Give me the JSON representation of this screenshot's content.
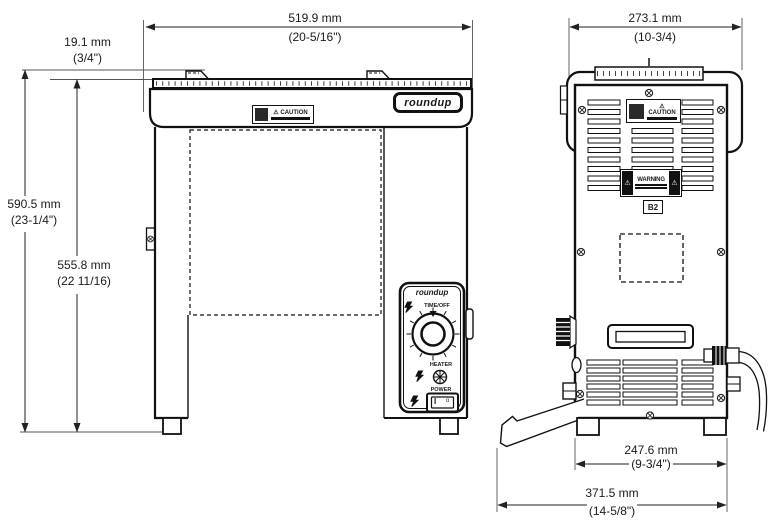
{
  "product": {
    "brand": "roundup"
  },
  "dimensions": {
    "overall_width": {
      "mm": "519.9 mm",
      "inches": "(20-5/16\")"
    },
    "tray_lip_height": {
      "mm": "19.1 mm",
      "inches": "(3/4\")"
    },
    "overall_height": {
      "mm": "590.5 mm",
      "inches": "(23-1/4\")"
    },
    "body_height": {
      "mm": "555.8 mm",
      "inches": "(22 11/16)"
    },
    "overall_depth_top": {
      "mm": "273.1 mm",
      "inches": "(10-3/4)"
    },
    "foot_depth": {
      "mm": "247.6 mm",
      "inches": "(9-3/4\")"
    },
    "overall_depth_bottom": {
      "mm": "371.5 mm",
      "inches": "(14-5/8\")"
    }
  },
  "labels": {
    "caution_icon": "⚠",
    "caution_title": "CAUTION",
    "warning_icon": "⚠",
    "warning_title": "WARNING",
    "model_code": "B2",
    "timer_label": "TIME/OFF",
    "heater_label": "HEATER",
    "power_label": "POWER",
    "switch_on": "I",
    "switch_off": "o"
  }
}
